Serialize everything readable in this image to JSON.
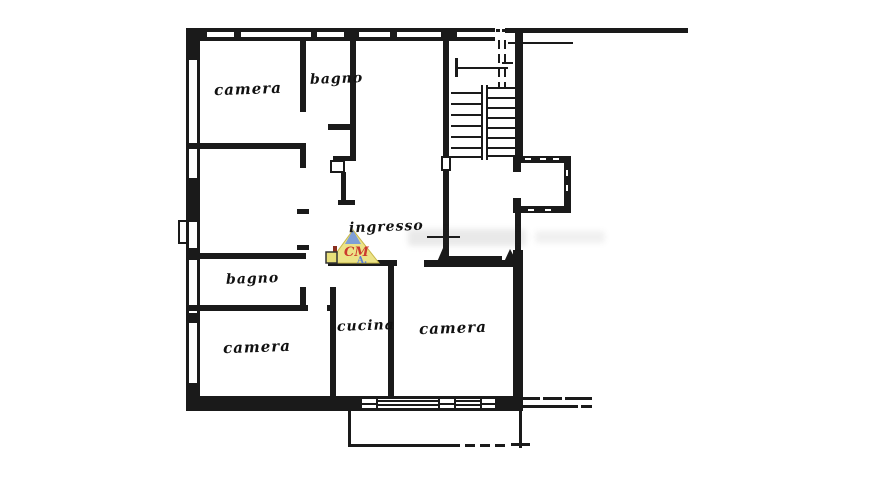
{
  "document": {
    "type": "apartment floor plan (scanned drawing)",
    "background": "#ffffff",
    "line_color": "#1a1a1a"
  },
  "rooms": [
    {
      "id": "camera-top-left",
      "label": "camera"
    },
    {
      "id": "bagno-top",
      "label": "bagno"
    },
    {
      "id": "ingresso",
      "label": "ingresso"
    },
    {
      "id": "bagno-middle",
      "label": "bagno"
    },
    {
      "id": "camera-bottom-left",
      "label": "camera"
    },
    {
      "id": "cucina",
      "label": "cucina"
    },
    {
      "id": "camera-bottom-right",
      "label": "camera"
    }
  ],
  "features": {
    "staircase": "stairwell with two flights and direction arrow",
    "elevator": "shaft right of stairs",
    "balcony": "below bottom wall"
  },
  "watermark": {
    "line1": "CM",
    "line2": "A.",
    "colors": {
      "yellow": "#ece387",
      "blue": "#7f9fd6",
      "red": "#cc3a2e",
      "dark_red": "#8a2f1f"
    }
  }
}
